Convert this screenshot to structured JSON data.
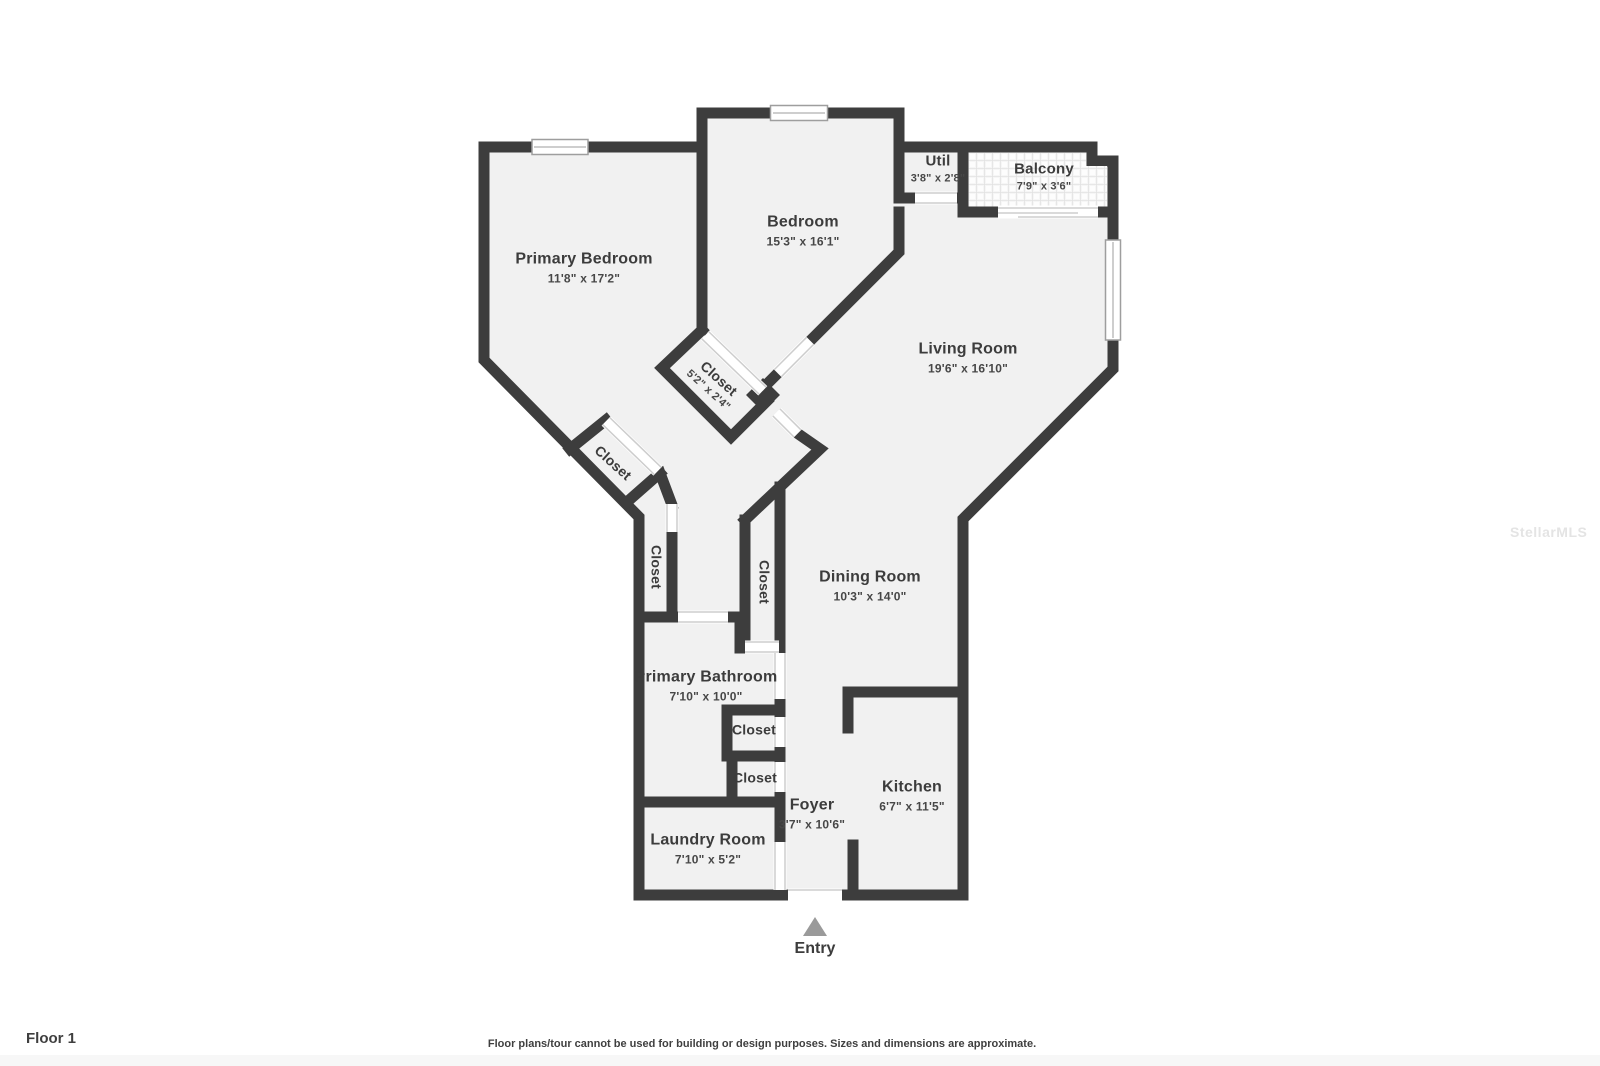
{
  "colors": {
    "wall": "#3d3d3d",
    "floor": "#f1f1f1",
    "balcony_tile_line": "#e2e2e2",
    "door_line": "#cdcdcd",
    "window_line": "#9e9e9e",
    "entry_arrow": "#9a9a9a",
    "text": "#3c3c3c",
    "watermark": "#e4e4e4"
  },
  "rooms": [
    {
      "name": "Primary Bedroom",
      "dims": "11'8\" x 17'2\""
    },
    {
      "name": "Bedroom",
      "dims": "15'3\" x 16'1\""
    },
    {
      "name": "Util",
      "dims": "3'8\" x 2'8\""
    },
    {
      "name": "Balcony",
      "dims": "7'9\" x 3'6\""
    },
    {
      "name": "Living Room",
      "dims": "19'6\" x 16'10\""
    },
    {
      "name": "Dining Room",
      "dims": "10'3\" x 14'0\""
    },
    {
      "name": "Primary Bathroom",
      "dims": "7'10\" x 10'0\""
    },
    {
      "name": "Kitchen",
      "dims": "6'7\" x 11'5\""
    },
    {
      "name": "Foyer",
      "dims": "3'7\" x 10'6\""
    },
    {
      "name": "Laundry Room",
      "dims": "7'10\" x 5'2\""
    },
    {
      "name": "Closet",
      "dims": "5'2\" x 2'4\""
    },
    {
      "name": "Closet"
    },
    {
      "name": "Closet"
    },
    {
      "name": "Closet"
    },
    {
      "name": "Closet"
    },
    {
      "name": "Closet"
    }
  ],
  "entry": {
    "label": "Entry"
  },
  "footer": {
    "floor_label": "Floor 1",
    "disclaimer": "Floor plans/tour cannot be used for building or design purposes. Sizes and dimensions are approximate."
  },
  "watermark": {
    "text": "StellarMLS"
  }
}
